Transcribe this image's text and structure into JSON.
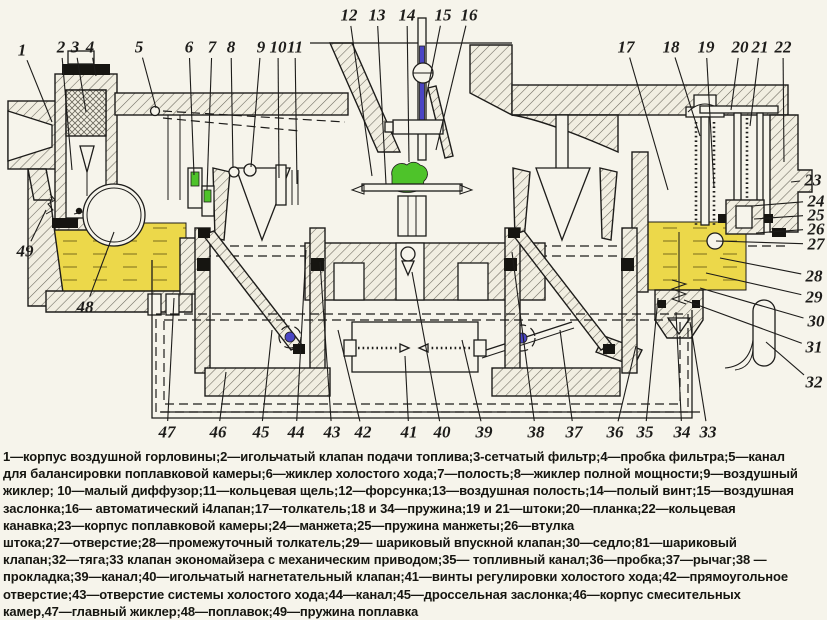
{
  "figure": {
    "type": "technical-cross-section-diagram",
    "subject": "carburetor",
    "colors": {
      "paper": "#f6f4eb",
      "ink": "#1d1c1a",
      "metal": "#f1eee1",
      "hatchline": "#6a675c",
      "fuel": "#ecd84a",
      "fueldash": "#8d7f23",
      "green": "#4ec32a",
      "blue": "#4a45c4",
      "seal": "#161511"
    },
    "callouts": [
      {
        "n": "1",
        "x": 22,
        "y": 50,
        "tx": 52,
        "ty": 122
      },
      {
        "n": "2",
        "x": 61,
        "y": 47,
        "tx": 72,
        "ty": 170
      },
      {
        "n": "3",
        "x": 75,
        "y": 47,
        "tx": 86,
        "ty": 112
      },
      {
        "n": "4",
        "x": 90,
        "y": 47,
        "tx": 96,
        "ty": 76
      },
      {
        "n": "5",
        "x": 139,
        "y": 47,
        "tx": 156,
        "ty": 108
      },
      {
        "n": "6",
        "x": 189,
        "y": 47,
        "tx": 194,
        "ty": 175
      },
      {
        "n": "7",
        "x": 212,
        "y": 47,
        "tx": 207,
        "ty": 190
      },
      {
        "n": "8",
        "x": 231,
        "y": 47,
        "tx": 233,
        "ty": 168
      },
      {
        "n": "9",
        "x": 261,
        "y": 47,
        "tx": 251,
        "ty": 167
      },
      {
        "n": "10",
        "x": 278,
        "y": 47,
        "tx": 279,
        "ty": 178
      },
      {
        "n": "11",
        "x": 295,
        "y": 47,
        "tx": 297,
        "ty": 184
      },
      {
        "n": "12",
        "x": 349,
        "y": 15,
        "tx": 372,
        "ty": 176
      },
      {
        "n": "13",
        "x": 377,
        "y": 15,
        "tx": 386,
        "ty": 184
      },
      {
        "n": "14",
        "x": 407,
        "y": 15,
        "tx": 409,
        "ty": 162
      },
      {
        "n": "15",
        "x": 443,
        "y": 15,
        "tx": 426,
        "ty": 98
      },
      {
        "n": "16",
        "x": 469,
        "y": 15,
        "tx": 436,
        "ty": 150
      },
      {
        "n": "17",
        "x": 626,
        "y": 47,
        "tx": 668,
        "ty": 190
      },
      {
        "n": "18",
        "x": 671,
        "y": 47,
        "tx": 700,
        "ty": 136
      },
      {
        "n": "19",
        "x": 706,
        "y": 47,
        "tx": 714,
        "ty": 188
      },
      {
        "n": "20",
        "x": 740,
        "y": 47,
        "tx": 731,
        "ty": 110
      },
      {
        "n": "21",
        "x": 760,
        "y": 47,
        "tx": 750,
        "ty": 126
      },
      {
        "n": "22",
        "x": 783,
        "y": 47,
        "tx": 784,
        "ty": 162
      },
      {
        "n": "23",
        "x": 813,
        "y": 180,
        "tx": 791,
        "ty": 182
      },
      {
        "n": "24",
        "x": 816,
        "y": 201,
        "tx": 752,
        "ty": 206
      },
      {
        "n": "25",
        "x": 816,
        "y": 215,
        "tx": 754,
        "ty": 219
      },
      {
        "n": "26",
        "x": 816,
        "y": 229,
        "tx": 756,
        "ty": 233
      },
      {
        "n": "27",
        "x": 816,
        "y": 244,
        "tx": 716,
        "ty": 241
      },
      {
        "n": "28",
        "x": 814,
        "y": 276,
        "tx": 720,
        "ty": 258
      },
      {
        "n": "29",
        "x": 814,
        "y": 297,
        "tx": 706,
        "ty": 273
      },
      {
        "n": "30",
        "x": 816,
        "y": 321,
        "tx": 700,
        "ty": 288
      },
      {
        "n": "31",
        "x": 814,
        "y": 347,
        "tx": 684,
        "ty": 300
      },
      {
        "n": "32",
        "x": 814,
        "y": 382,
        "tx": 766,
        "ty": 342
      },
      {
        "n": "33",
        "x": 708,
        "y": 432,
        "tx": 690,
        "ty": 322
      },
      {
        "n": "34",
        "x": 682,
        "y": 432,
        "tx": 676,
        "ty": 312
      },
      {
        "n": "35",
        "x": 645,
        "y": 432,
        "tx": 658,
        "ty": 298
      },
      {
        "n": "36",
        "x": 615,
        "y": 432,
        "tx": 636,
        "ty": 346
      },
      {
        "n": "37",
        "x": 574,
        "y": 432,
        "tx": 560,
        "ty": 330
      },
      {
        "n": "38",
        "x": 536,
        "y": 432,
        "tx": 512,
        "ty": 252
      },
      {
        "n": "39",
        "x": 484,
        "y": 432,
        "tx": 462,
        "ty": 340
      },
      {
        "n": "40",
        "x": 442,
        "y": 432,
        "tx": 412,
        "ty": 272
      },
      {
        "n": "41",
        "x": 409,
        "y": 432,
        "tx": 405,
        "ty": 356
      },
      {
        "n": "42",
        "x": 363,
        "y": 432,
        "tx": 338,
        "ty": 330
      },
      {
        "n": "43",
        "x": 332,
        "y": 432,
        "tx": 320,
        "ty": 262
      },
      {
        "n": "44",
        "x": 296,
        "y": 432,
        "tx": 306,
        "ty": 250
      },
      {
        "n": "45",
        "x": 261,
        "y": 432,
        "tx": 272,
        "ty": 330
      },
      {
        "n": "46",
        "x": 218,
        "y": 432,
        "tx": 226,
        "ty": 372
      },
      {
        "n": "47",
        "x": 167,
        "y": 432,
        "tx": 174,
        "ty": 298
      },
      {
        "n": "48",
        "x": 85,
        "y": 307,
        "tx": 114,
        "ty": 232
      },
      {
        "n": "49",
        "x": 25,
        "y": 251,
        "tx": 46,
        "ty": 210
      }
    ]
  },
  "caption": {
    "lines": [
      "1—корпус воздушной горловины;2—игольчатый клапан подачи топлива;3-сетчатый фильтр;4—пробка фильтра;5—канал",
      "для балансировки поплавковой камеры;6—жиклер холостого хода;7—полость;8—жиклер полной мощности;9—воздушный",
      "жиклер; 10—малый диффузор;11—кольцевая щель;12—форсунка;13—воздушная полость;14—полый винт;15—воздушная",
      "заслонка;16— автоматический i4лапан;17—толкатель;18 и 34—пружина;19 и 21—штоки;20—планка;22—кольцевая",
      "канавка;23—корпус поплавковой камеры;24—манжета;25—пружина манжеты;26—втулка",
      "штока;27—отверстие;28—промежуточный толкатель;29— шариковый впускной клапан;30—седло;81—шариковый",
      "клапан;32—тяга;33 клапан экономайзера с механическим приводом;35— топливный канал;36—пробка;37—рычаг;38 —",
      "прокладка;39—канал;40—игольчатый нагнетательный клапан;41—винты регулировки холостого хода;42—прямоугольное",
      "отверстие;43—отверстие системы холостого хода;44—канал;45—дроссельная заслонка;46—корпус смесительных",
      "камер,47—главный жиклер;48—поплавок;49—пружина поплавка"
    ]
  }
}
